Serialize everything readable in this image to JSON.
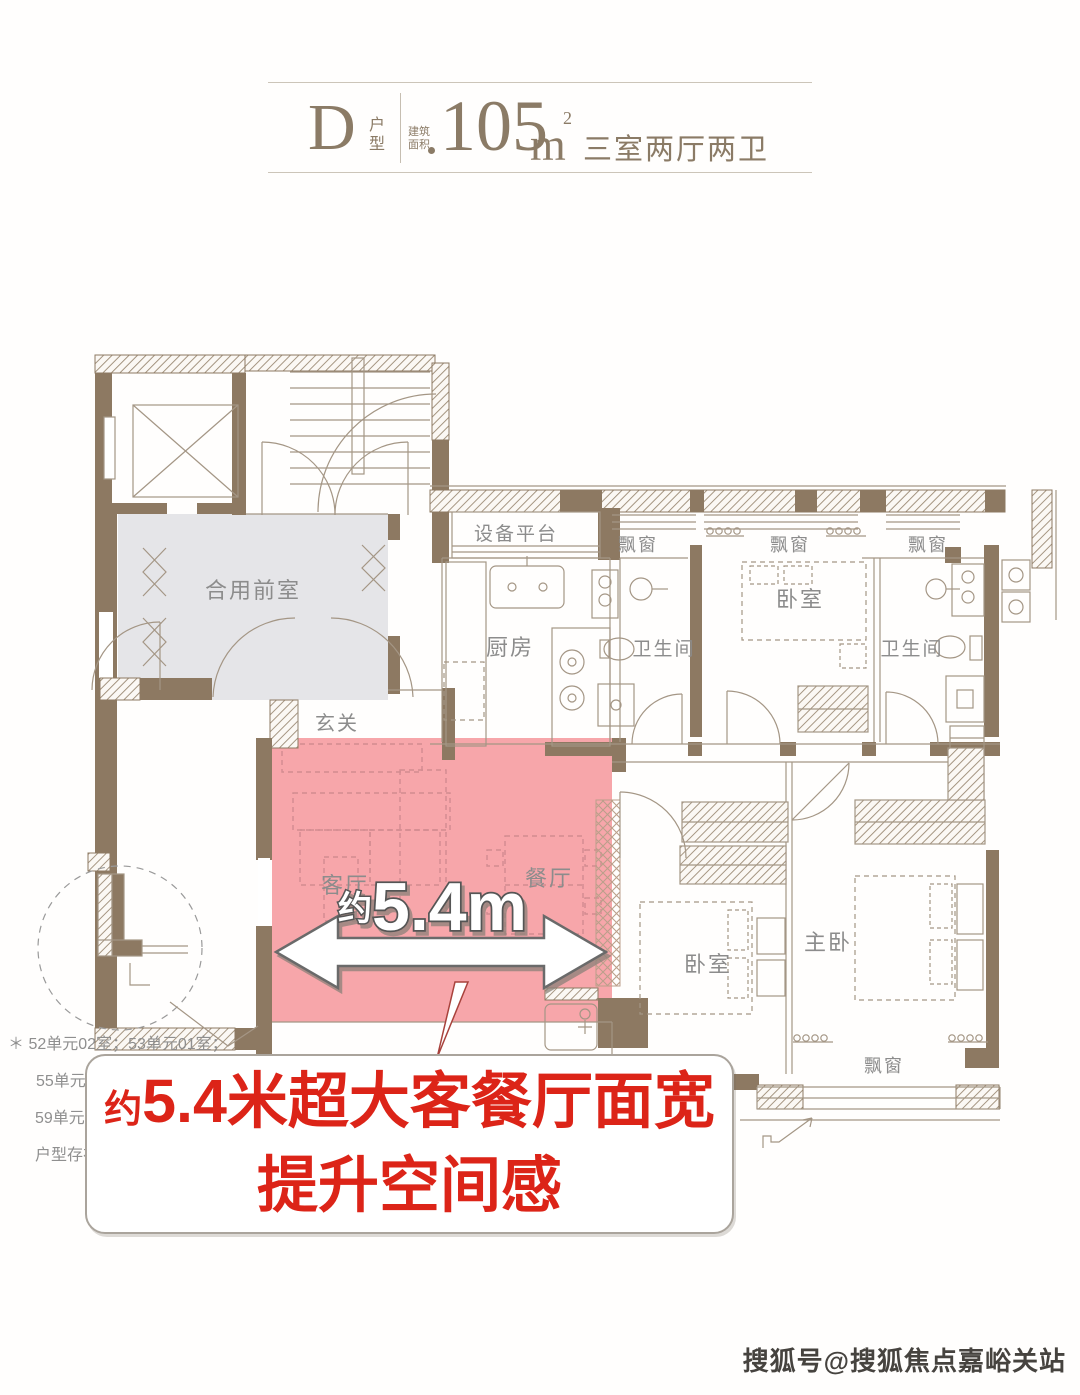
{
  "header": {
    "type_letter": "D",
    "type_label": "户型",
    "area_label_line1": "建筑",
    "area_label_line2": "面积",
    "area_value": "105",
    "area_unit": "m",
    "area_exponent": "2",
    "rooms_summary": "三室两厅两卫"
  },
  "plan": {
    "labels": {
      "shared_front_room": "合用前室",
      "equipment_platform": "设备平台",
      "kitchen": "厨房",
      "foyer": "玄关",
      "living_room": "客厅",
      "dining_room": "餐厅",
      "bedroom_top": "卧室",
      "bedroom_middle": "卧室",
      "master_bedroom": "主卧",
      "bathroom_top": "卫生间",
      "bathroom_right": "卫生间",
      "bay_window_1": "飘窗",
      "bay_window_2": "飘窗",
      "bay_window_3": "飘窗",
      "bay_window_4": "飘窗"
    },
    "dimension": {
      "prefix": "约",
      "value": "5.4m"
    }
  },
  "footnote": {
    "marker": "＊",
    "line1": "52单元02室；53单元01室；",
    "line2": "55单元0",
    "line3": "59单元01",
    "line4": "户型存在"
  },
  "callout_banner": {
    "line1_prefix": "约",
    "line1_text": "5.4米超大客餐厅面宽",
    "line2_text": "提升空间感"
  },
  "watermark": "搜狐号@搜狐焦点嘉峪关站",
  "colors": {
    "wall_brown": "#8d7962",
    "highlight_pink": "#f7a6aa",
    "banner_red": "#dc2418",
    "header_brown": "#8b7b66",
    "room_fill_gray": "#e5e5e8"
  }
}
